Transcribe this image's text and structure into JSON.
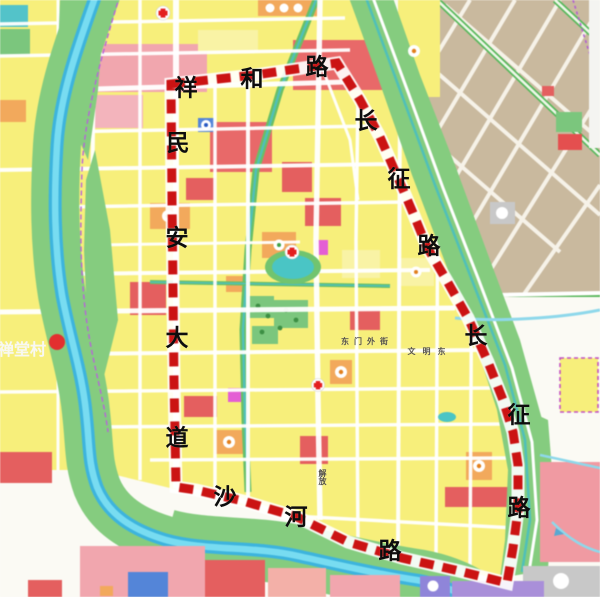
{
  "map": {
    "type": "urban-landuse-planning-map",
    "village_label": "禅堂村",
    "boundary": {
      "color": "#c81414",
      "roads": [
        "祥和路",
        "长征路",
        "沙河路",
        "民安大道"
      ]
    },
    "palette": {
      "boundary_red": "#c81414",
      "residential_yellow": "#f7ef7d",
      "commercial_red": "#e26060",
      "pink_mixed": "#f0a6ae",
      "school_orange": "#f1a95e",
      "park_green": "#82c97c",
      "water_blue": "#5ecbe8",
      "pond_teal": "#4cc4c4",
      "existing_town_tan": "#c9b99f",
      "road_white": "#ffffff",
      "utility_magenta": "#e25fd2",
      "facility_blue": "#5585d6",
      "special_purple": "#a98fd8",
      "storage_gray": "#c8c8c8"
    },
    "labels": [
      {
        "name": "road-label-xianghe-1",
        "text": "祥",
        "x": 186,
        "y": 88,
        "size": 23,
        "color": "#0d0d0d"
      },
      {
        "name": "road-label-xianghe-2",
        "text": "和",
        "x": 252,
        "y": 79,
        "size": 23,
        "color": "#0d0d0d"
      },
      {
        "name": "road-label-xianghe-3",
        "text": "路",
        "x": 317,
        "y": 67,
        "size": 23,
        "color": "#0d0d0d"
      },
      {
        "name": "road-label-minan-1",
        "text": "民",
        "x": 178,
        "y": 143,
        "size": 23,
        "color": "#0d0d0d"
      },
      {
        "name": "road-label-minan-2",
        "text": "安",
        "x": 177,
        "y": 238,
        "size": 23,
        "color": "#0d0d0d"
      },
      {
        "name": "road-label-minan-3",
        "text": "大",
        "x": 177,
        "y": 338,
        "size": 23,
        "color": "#0d0d0d"
      },
      {
        "name": "road-label-minan-4",
        "text": "道",
        "x": 177,
        "y": 438,
        "size": 23,
        "color": "#0d0d0d"
      },
      {
        "name": "road-label-changzheng-upper-1",
        "text": "长",
        "x": 366,
        "y": 121,
        "size": 23,
        "color": "#0d0d0d"
      },
      {
        "name": "road-label-changzheng-upper-2",
        "text": "征",
        "x": 399,
        "y": 179,
        "size": 23,
        "color": "#0d0d0d"
      },
      {
        "name": "road-label-changzheng-upper-3",
        "text": "路",
        "x": 429,
        "y": 246,
        "size": 23,
        "color": "#0d0d0d"
      },
      {
        "name": "road-label-changzheng-lower-1",
        "text": "长",
        "x": 476,
        "y": 336,
        "size": 23,
        "color": "#0d0d0d"
      },
      {
        "name": "road-label-changzheng-lower-2",
        "text": "征",
        "x": 519,
        "y": 415,
        "size": 23,
        "color": "#0d0d0d"
      },
      {
        "name": "road-label-changzheng-lower-3",
        "text": "路",
        "x": 519,
        "y": 508,
        "size": 23,
        "color": "#0d0d0d"
      },
      {
        "name": "road-label-shahe-1",
        "text": "沙",
        "x": 225,
        "y": 497,
        "size": 23,
        "color": "#0d0d0d"
      },
      {
        "name": "road-label-shahe-2",
        "text": "河",
        "x": 296,
        "y": 517,
        "size": 23,
        "color": "#0d0d0d"
      },
      {
        "name": "road-label-shahe-3",
        "text": "路",
        "x": 390,
        "y": 551,
        "size": 23,
        "color": "#0d0d0d"
      },
      {
        "name": "village-label",
        "text": "禅堂村",
        "x": 22,
        "y": 351,
        "size": 16,
        "color": "#f8f8f2"
      },
      {
        "name": "street-label-dongmenwai",
        "text": "东门外街",
        "x": 367,
        "y": 342,
        "size": 8,
        "color": "#55524a",
        "spacing": 5
      },
      {
        "name": "street-label-wenmingdong",
        "text": "文明东",
        "x": 430,
        "y": 352,
        "size": 8,
        "color": "#55524a",
        "spacing": 7
      },
      {
        "name": "street-label-jiefang",
        "text": "解放",
        "x": 322,
        "y": 477,
        "size": 8,
        "color": "#55524a",
        "vertical": true
      }
    ]
  }
}
